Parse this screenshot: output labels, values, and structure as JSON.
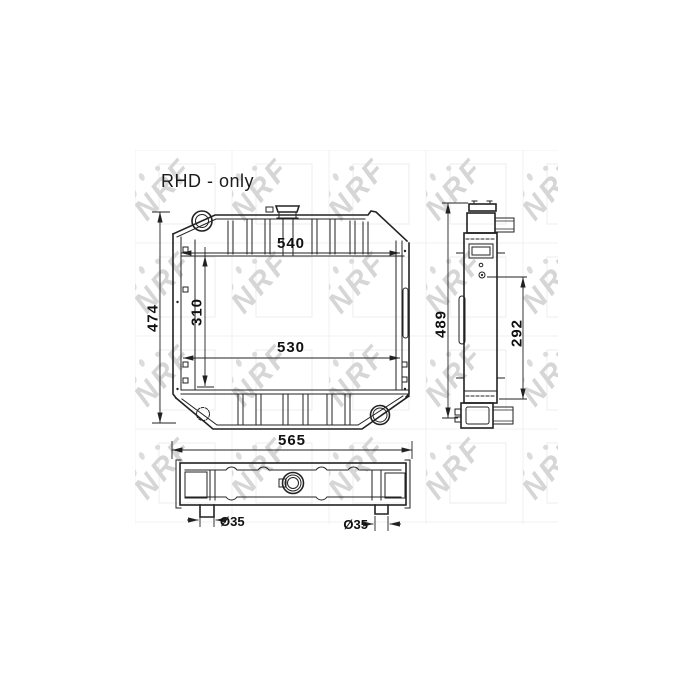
{
  "note": {
    "text": "RHD - only"
  },
  "watermark": {
    "brand": "NRF",
    "color": "#d6d6d6"
  },
  "colors": {
    "line": "#222222",
    "text": "#111111",
    "background": "#ffffff"
  },
  "front_view": {
    "dim_top_width": "540",
    "dim_core_height": "310",
    "dim_bottom_width": "530",
    "dim_overall_height": "474"
  },
  "side_view": {
    "dim_overall_height": "489",
    "dim_core_height": "292"
  },
  "bottom_view": {
    "dim_overall_width": "565",
    "dim_left_pipe": "Ø35",
    "dim_right_pipe": "Ø35"
  }
}
